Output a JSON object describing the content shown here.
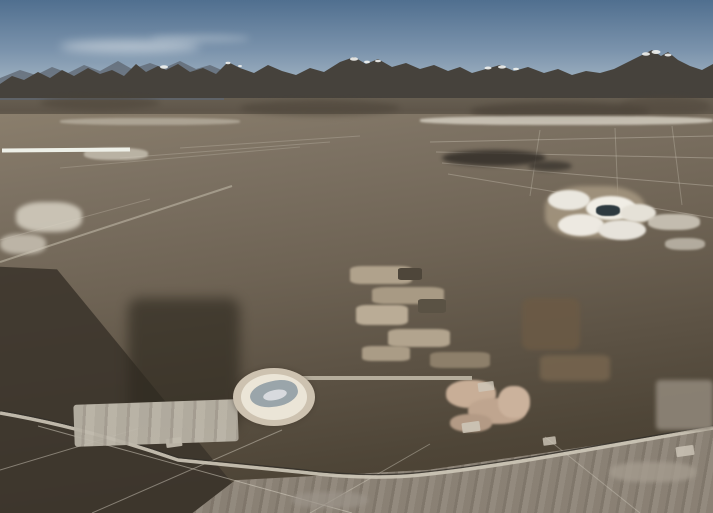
{
  "meta": {
    "title": "Aerial photograph of lithium brine evaporation ponds on a desert salt flat with a snow-capped mountain range on the horizon",
    "subject": "lithium-evaporation-ponds",
    "setting": "high desert salt flat, mountain range, clear blue sky"
  },
  "palette": {
    "sky-top": "#506f8f",
    "sky-mid": "#7b93ac",
    "sky-horizon": "#a9bac7",
    "mountain": "#46423c",
    "foothill": "#6f6759",
    "plain": "#7d7263",
    "plain-dark": "#463e31",
    "dark-earth": "#3b342b",
    "road": "#cdc6b8",
    "teal-pond": "#5cc2b8",
    "yellow-pond": "#e0e020",
    "salt-white": "#e8e6de"
  },
  "scene": {
    "pond_blocks": [
      {
        "name": "distant-pale-pond-strip",
        "x": 2,
        "y": 148,
        "w": 128,
        "rotate": -0.5,
        "gap": 1,
        "row_gap": 0,
        "frame": "#eef0e8",
        "rows": [
          {
            "h": 13,
            "cells": [
              "#cfeef0",
              "#e6f2ef",
              "#bfe8ea",
              "#dff0ee",
              "#cdeff0",
              "#e8f1ee"
            ]
          }
        ]
      },
      {
        "name": "back-pond-row-1",
        "x": 72,
        "y": 164,
        "w": 190,
        "rotate": -1.5,
        "gap": 2,
        "row_gap": 0,
        "rows": [
          {
            "h": 13,
            "cells": [
              "#3f8fa0",
              "#dfe3dc",
              "#57bdb7",
              "#e4e7e0",
              "#6fc9c0",
              "#c3d8d3",
              "#55bab2"
            ]
          }
        ]
      },
      {
        "name": "back-pond-row-2",
        "x": 250,
        "y": 169,
        "w": 210,
        "rotate": -1.5,
        "gap": 2,
        "row_gap": 0,
        "rows": [
          {
            "h": 14,
            "cells": [
              "#58c2b8",
              "#e7eae2",
              "#49b5ac",
              "#63c8bd",
              "#dfe4da",
              "#54bdb4",
              "#8ed5cb"
            ]
          }
        ]
      },
      {
        "name": "back-pond-row-3",
        "x": 458,
        "y": 176,
        "w": 162,
        "rotate": -1,
        "gap": 2,
        "row_gap": 0,
        "rows": [
          {
            "h": 16,
            "cells": [
              "#4ab6ae",
              "#71ccc2",
              "#dce2d8",
              "#55bfb6",
              "#85d2c8"
            ]
          }
        ]
      },
      {
        "name": "main-teal-pond-block",
        "x": 58,
        "y": 187,
        "w": 555,
        "rotate": -1.2,
        "gap": 2,
        "row_gap": 3,
        "rows": [
          {
            "h": 14,
            "cells": [
              "#20405a",
              "#52bcb3",
              "#dcdfd6",
              "#66c8be",
              "#48b2a9",
              "#8bd5cb",
              "#d8ddd2",
              "#5cc2b8",
              "#6fcac0",
              "#b9d2cc",
              "#54bdb4",
              "#e2e5da",
              "#62c5bb",
              "#7bcfc5"
            ]
          },
          {
            "h": 16,
            "x": 52,
            "w": 570,
            "cells": [
              "#6ac8be",
              "#50b8af",
              "#dfe2d8",
              "#73ccc2",
              "#5fc2b9",
              "#95d8ce",
              "#49b3aa",
              "#dcdfd4",
              "#67c6bc",
              "#7ed0c6",
              "#58bfb6",
              "#c5d8d1",
              "#6bc8be",
              "#85d2c8"
            ]
          },
          {
            "h": 19,
            "x": 47,
            "w": 582,
            "cells": [
              "#dfe3d8",
              "#5dc2b8",
              "#79cec4",
              "#52b9b0",
              "#9cdad0",
              "#66c5bb",
              "#dbe0d4",
              "#71cac0",
              "#5abfb6",
              "#8ad3c9",
              "#63c4ba",
              "#e1e4d9",
              "#55bcb3",
              "#92d6cc"
            ]
          },
          {
            "h": 22,
            "x": 42,
            "w": 594,
            "cells": [
              "#68c6bc",
              "#8fd5cb",
              "#55bcb3",
              "#dde1d6",
              "#74ccc2",
              "#5ec1b8",
              "#a5ddd3",
              "#4fb7ae",
              "#dfe2d7",
              "#6ac7bd",
              "#7fd0c6",
              "#59beb5",
              "#cdddd5",
              "#64c4ba"
            ]
          }
        ]
      },
      {
        "name": "right-teal-ponds",
        "x": 575,
        "y": 234,
        "w": 132,
        "rotate": 3,
        "gap": 3,
        "row_gap": 0,
        "rows": [
          {
            "h": 22,
            "cells": [
              "#57c1b8",
              "#7fd0c6",
              "#4db6ad",
              "#90d6cc"
            ]
          }
        ]
      },
      {
        "name": "green-pond-rows",
        "x": 52,
        "y": 260,
        "w": 396,
        "rotate": -1,
        "gap": 2,
        "row_gap": 3,
        "rows": [
          {
            "h": 15,
            "cells": [
              "#64be74",
              "#8ed189",
              "#4aa362",
              "#a3db94",
              "#79c67e",
              "#8b7d68",
              "#5bb56e",
              "#98d58e",
              "#6fc278",
              "#b2e09c"
            ]
          },
          {
            "h": 16,
            "cells": [
              "#88cf86",
              "#a8dd98",
              "#6abf76",
              "#c0e6a6",
              "#57b06a",
              "#93d38b",
              "#7ac87f",
              "#a88f72",
              "#63ba72",
              "#8ed189"
            ]
          }
        ]
      },
      {
        "name": "mint-pond-columns",
        "x": 350,
        "y": 296,
        "w": 78,
        "rotate": 0,
        "gap": 8,
        "row_gap": 2,
        "rows": [
          {
            "h": 19,
            "cells": [
              "#8fd898",
              "#c9eec6"
            ]
          },
          {
            "h": 20,
            "cells": [
              "#9dde9f",
              "#b9e8b2"
            ]
          },
          {
            "h": 21,
            "cells": [
              "#8ad494",
              "#d4f0d0"
            ]
          },
          {
            "h": 22,
            "cells": [
              "#97da9c",
              "#afe4ac"
            ]
          },
          {
            "h": 23,
            "cells": [
              "#8ed795",
              "#c2ecba"
            ]
          }
        ]
      },
      {
        "name": "left-green-yellow-block",
        "x": 82,
        "y": 296,
        "w": 248,
        "rotate": -1,
        "gap": 3,
        "row_gap": 3,
        "rows": [
          {
            "h": 25,
            "cells": [
              "#b4e47c",
              "#cdec8e",
              "#c2bba8",
              "#a9e08f",
              "#8fd586"
            ]
          },
          {
            "h": 27,
            "cells": [
              "#cbe148",
              "#b3ada0",
              "#dde93e",
              "#a5de8c",
              "#c3de3a"
            ]
          },
          {
            "h": 28,
            "cells": [
              "#dfe824",
              "#c9dc2c",
              "#e6ea1e",
              "#b8d028",
              "#d5e122"
            ]
          },
          {
            "h": 26,
            "x": 100,
            "w": 150,
            "cells": [
              "#e4e518",
              "#ede912",
              "#d8da14"
            ]
          }
        ]
      },
      {
        "name": "left-pale-pond-column",
        "x": 50,
        "y": 300,
        "w": 30,
        "rotate": 0,
        "gap": 2,
        "row_gap": 3,
        "rows": [
          {
            "h": 28,
            "cells": [
              "#e8f0a8"
            ]
          },
          {
            "h": 28,
            "cells": [
              "#dce98c"
            ]
          },
          {
            "h": 28,
            "cells": [
              "#eef2b8"
            ]
          }
        ]
      },
      {
        "name": "right-yellow-block",
        "x": 492,
        "y": 256,
        "w": 218,
        "rotate": 5,
        "gap": 3,
        "row_gap": 3,
        "rows": [
          {
            "h": 18,
            "cells": [
              "#e0e020",
              "#d6da1e",
              "#e8e818",
              "#cbd01e",
              "#e3e31a",
              "#d8dc16"
            ]
          },
          {
            "h": 20,
            "cells": [
              "#d4d81a",
              "#e6e614",
              "#c9ce18",
              "#dfdf12",
              "#d0d516",
              "#e4e410"
            ]
          },
          {
            "h": 21,
            "cells": [
              "#afbc1c",
              "#c2cc1a",
              "#9baa18",
              "#b8c41e",
              "#a5b216",
              "#bfc91a"
            ]
          },
          {
            "h": 18,
            "cells": [
              "#7ec04a",
              "#94ce40",
              "#6ab446",
              "#88c83c",
              "#79be42",
              "#8fca38"
            ]
          }
        ]
      },
      {
        "name": "far-right-pale-ponds",
        "x": 688,
        "y": 260,
        "w": 25,
        "rotate": 2,
        "gap": 2,
        "row_gap": 3,
        "rows": [
          {
            "h": 32,
            "cells": [
              "#cfeac0"
            ]
          },
          {
            "h": 32,
            "cells": [
              "#bce4b0"
            ]
          }
        ]
      },
      {
        "name": "right-green-strip",
        "x": 568,
        "y": 342,
        "w": 126,
        "rotate": 4,
        "gap": 3,
        "row_gap": 0,
        "rows": [
          {
            "h": 12,
            "cells": [
              "#7ac83c",
              "#8dd232",
              "#68bc36",
              "#9bda2e"
            ]
          }
        ]
      },
      {
        "name": "right-lower-yellow",
        "x": 598,
        "y": 352,
        "w": 110,
        "rotate": 5,
        "gap": 3,
        "row_gap": 0,
        "rows": [
          {
            "h": 14,
            "cells": [
              "#e2e412",
              "#d6da10",
              "#cdd40e"
            ]
          }
        ]
      },
      {
        "name": "center-bottom-pond-block",
        "x": 300,
        "y": 376,
        "w": 172,
        "rotate": 0,
        "gap": 5,
        "row_gap": 4,
        "frame": "#b5ad9c",
        "rows": [
          {
            "h": 20,
            "cells": [
              "#c4ec9c",
              "#b4e896"
            ]
          },
          {
            "h": 22,
            "cells": [
              "#c6d226",
              "#9cc832"
            ]
          },
          {
            "h": 22,
            "cells": [
              "#bbbe1a",
              "#b2bc20"
            ]
          },
          {
            "h": 20,
            "cells": [
              "#acb014",
              "#a4aa12"
            ]
          },
          {
            "h": 7,
            "cells": [
              "#d8e0b0",
              "#5a6a3a",
              "#cdd8a0",
              "#9aa850"
            ]
          }
        ]
      }
    ],
    "blobs": [
      {
        "name": "salt-mound-pad",
        "x": 545,
        "y": 186,
        "w": 100,
        "h": 52,
        "c": "#a3957f",
        "o": 0.9,
        "b": 2,
        "r": 40
      },
      {
        "name": "salt-mound",
        "x": 548,
        "y": 190,
        "w": 42,
        "h": 20,
        "c": "#eae7df",
        "o": 1,
        "b": 1,
        "r": 50
      },
      {
        "name": "salt-mound",
        "x": 586,
        "y": 196,
        "w": 50,
        "h": 24,
        "c": "#f0ede5",
        "o": 1,
        "b": 1,
        "r": 50
      },
      {
        "name": "salt-mound",
        "x": 620,
        "y": 204,
        "w": 36,
        "h": 18,
        "c": "#e5e1d7",
        "o": 1,
        "b": 1,
        "r": 50
      },
      {
        "name": "salt-mound",
        "x": 558,
        "y": 214,
        "w": 46,
        "h": 22,
        "c": "#ede9e1",
        "o": 1,
        "b": 1,
        "r": 50
      },
      {
        "name": "salt-mound",
        "x": 598,
        "y": 220,
        "w": 48,
        "h": 20,
        "c": "#e7e3db",
        "o": 1,
        "b": 1,
        "r": 50
      },
      {
        "name": "brine-pool-dark",
        "x": 596,
        "y": 205,
        "w": 24,
        "h": 11,
        "c": "#2e3a40",
        "o": 1,
        "b": 0.5,
        "r": 40
      },
      {
        "name": "salt-patch",
        "x": 648,
        "y": 214,
        "w": 52,
        "h": 16,
        "c": "#d9d3c6",
        "o": 0.8,
        "b": 1,
        "r": 40
      },
      {
        "name": "salt-patch",
        "x": 665,
        "y": 238,
        "w": 40,
        "h": 12,
        "c": "#d2ccbf",
        "o": 0.7,
        "b": 1,
        "r": 40
      },
      {
        "name": "salt-patch",
        "x": 16,
        "y": 202,
        "w": 66,
        "h": 30,
        "c": "#d7d1c3",
        "o": 0.85,
        "b": 2,
        "r": 40
      },
      {
        "name": "salt-patch",
        "x": 0,
        "y": 234,
        "w": 46,
        "h": 20,
        "c": "#cec7b9",
        "o": 0.8,
        "b": 2,
        "r": 40
      },
      {
        "name": "salt-patch",
        "x": 84,
        "y": 148,
        "w": 64,
        "h": 12,
        "c": "#d2ccbe",
        "o": 0.7,
        "b": 1,
        "r": 40
      },
      {
        "name": "dark-smudge",
        "x": 442,
        "y": 150,
        "w": 104,
        "h": 16,
        "c": "#332e28",
        "o": 0.85,
        "b": 2,
        "r": 50
      },
      {
        "name": "dark-smudge",
        "x": 528,
        "y": 161,
        "w": 44,
        "h": 10,
        "c": "#3a352e",
        "o": 0.8,
        "b": 2,
        "r": 50
      },
      {
        "name": "facility-structure",
        "x": 350,
        "y": 266,
        "w": 62,
        "h": 18,
        "c": "#b0a28c",
        "o": 1,
        "b": 1,
        "r": 20
      },
      {
        "name": "facility-structure",
        "x": 372,
        "y": 287,
        "w": 72,
        "h": 17,
        "c": "#a89a84",
        "o": 1,
        "b": 1,
        "r": 20
      },
      {
        "name": "facility-structure",
        "x": 356,
        "y": 305,
        "w": 52,
        "h": 20,
        "c": "#baac96",
        "o": 1,
        "b": 1,
        "r": 20
      },
      {
        "name": "facility-structure",
        "x": 388,
        "y": 329,
        "w": 62,
        "h": 18,
        "c": "#b2a48e",
        "o": 1,
        "b": 1,
        "r": 20
      },
      {
        "name": "facility-structure",
        "x": 362,
        "y": 346,
        "w": 48,
        "h": 15,
        "c": "#aa9c86",
        "o": 1,
        "b": 1,
        "r": 20
      },
      {
        "name": "facility-building",
        "x": 418,
        "y": 299,
        "w": 28,
        "h": 14,
        "c": "#5a5244",
        "o": 1,
        "b": 0,
        "r": 15
      },
      {
        "name": "facility-building",
        "x": 398,
        "y": 268,
        "w": 24,
        "h": 12,
        "c": "#4e463a",
        "o": 1,
        "b": 0,
        "r": 15
      },
      {
        "name": "facility-structure",
        "x": 430,
        "y": 352,
        "w": 60,
        "h": 16,
        "c": "#8d7f6a",
        "o": 1,
        "b": 1,
        "r": 20
      },
      {
        "name": "earthworks",
        "x": 522,
        "y": 298,
        "w": 58,
        "h": 52,
        "c": "#6b5a45",
        "o": 0.9,
        "b": 2,
        "r": 15
      },
      {
        "name": "earthworks",
        "x": 540,
        "y": 355,
        "w": 70,
        "h": 26,
        "c": "#75644e",
        "o": 0.9,
        "b": 2,
        "r": 15
      },
      {
        "name": "tan-mound",
        "x": 446,
        "y": 380,
        "w": 50,
        "h": 28,
        "c": "#c8ae97",
        "o": 1,
        "b": 1,
        "r": 45
      },
      {
        "name": "tan-mound",
        "x": 468,
        "y": 398,
        "w": 58,
        "h": 26,
        "c": "#bfa58f",
        "o": 1,
        "b": 1,
        "r": 45
      },
      {
        "name": "tan-mound",
        "x": 450,
        "y": 414,
        "w": 42,
        "h": 18,
        "c": "#b39a85",
        "o": 1,
        "b": 1,
        "r": 45
      },
      {
        "name": "tan-mound",
        "x": 498,
        "y": 386,
        "w": 32,
        "h": 32,
        "c": "#cbb29c",
        "o": 1,
        "b": 1,
        "r": 45
      },
      {
        "name": "light-ground-wedge",
        "x": 656,
        "y": 380,
        "w": 57,
        "h": 50,
        "c": "#8f8679",
        "o": 0.9,
        "b": 2,
        "r": 8
      },
      {
        "name": "salt-streak",
        "x": 610,
        "y": 462,
        "w": 86,
        "h": 20,
        "c": "#a59c8f",
        "o": 0.8,
        "b": 2,
        "r": 40
      },
      {
        "name": "salt-streak",
        "x": 292,
        "y": 492,
        "w": 76,
        "h": 16,
        "c": "#9c948a",
        "o": 0.7,
        "b": 2,
        "r": 40
      },
      {
        "name": "dark-earth-patch",
        "x": 128,
        "y": 298,
        "w": 112,
        "h": 132,
        "c": "#2e291f",
        "o": 0.65,
        "b": 6,
        "r": 10
      },
      {
        "name": "foothill-shadow",
        "x": 40,
        "y": 96,
        "w": 120,
        "h": 14,
        "c": "#4a4237",
        "o": 0.5,
        "b": 3,
        "r": 50
      },
      {
        "name": "foothill-shadow",
        "x": 240,
        "y": 100,
        "w": 160,
        "h": 16,
        "c": "#4a4237",
        "o": 0.5,
        "b": 3,
        "r": 50
      },
      {
        "name": "foothill-shadow",
        "x": 470,
        "y": 102,
        "w": 180,
        "h": 18,
        "c": "#453d33",
        "o": 0.55,
        "b": 3,
        "r": 50
      },
      {
        "name": "foothill-shadow",
        "x": 620,
        "y": 96,
        "w": 90,
        "h": 20,
        "c": "#4f463b",
        "o": 0.5,
        "b": 3,
        "r": 50
      },
      {
        "name": "salt-flat-band",
        "x": 420,
        "y": 116,
        "w": 293,
        "h": 9,
        "c": "#d8d2c5",
        "o": 0.8,
        "b": 1,
        "r": 40
      },
      {
        "name": "salt-flat-band",
        "x": 60,
        "y": 118,
        "w": 180,
        "h": 7,
        "c": "#c6bfb0",
        "o": 0.6,
        "b": 1,
        "r": 40
      },
      {
        "name": "track-pad",
        "x": 166,
        "y": 438,
        "w": 16,
        "h": 9,
        "c": "#cfc8ba",
        "o": 0.85,
        "b": 0,
        "r": 10,
        "rot": -8
      },
      {
        "name": "track-pad",
        "x": 462,
        "y": 422,
        "w": 18,
        "h": 10,
        "c": "#cfc8ba",
        "o": 0.85,
        "b": 0,
        "r": 10,
        "rot": -8
      },
      {
        "name": "track-pad",
        "x": 543,
        "y": 437,
        "w": 13,
        "h": 8,
        "c": "#cfc8ba",
        "o": 0.8,
        "b": 0,
        "r": 10,
        "rot": -8
      },
      {
        "name": "track-pad",
        "x": 478,
        "y": 382,
        "w": 16,
        "h": 9,
        "c": "#cfc8ba",
        "o": 0.8,
        "b": 0,
        "r": 10,
        "rot": -8
      },
      {
        "name": "track-pad",
        "x": 676,
        "y": 446,
        "w": 18,
        "h": 10,
        "c": "#cfc8ba",
        "o": 0.8,
        "b": 0,
        "r": 10,
        "rot": -8
      }
    ]
  }
}
